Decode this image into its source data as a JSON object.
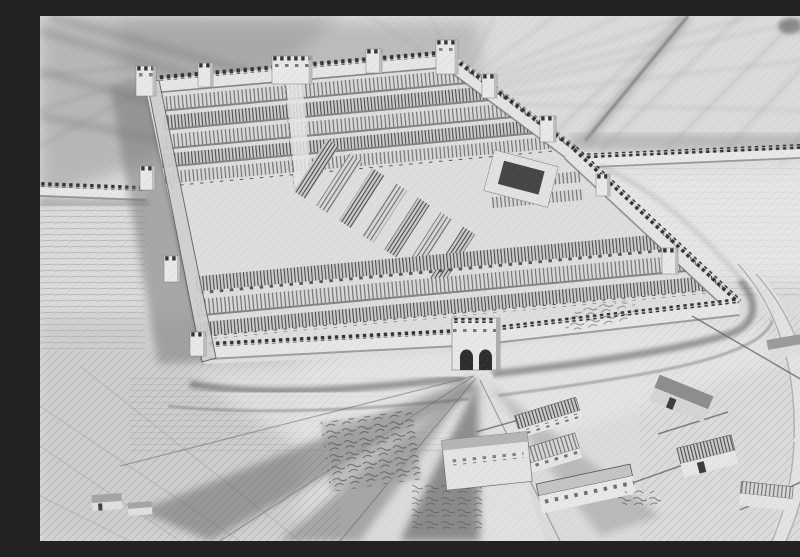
{
  "meta": {
    "title": "Bird's-eye reconstruction drawing of a Roman fort",
    "medium": "black-and-white engraving / pencil drawing, aerial perspective",
    "alt": "Aerial-perspective monochrome drawing of a walled Roman fort: crenellated curtain walls with corner and interval towers, a twin-arched south gatehouse, dense parallel rows of long barracks blocks inside, long walls running off to the left and right edges, a double ditch around the ramparts, dark roads radiating from the gate, sketched hatched farmland all around, and a small civilian settlement of pitched-roof houses in the foreground."
  },
  "palette": {
    "paper": "#e3e3e3",
    "highlight": "#f4f4f4",
    "field_mid": "#9a9a9a",
    "shade": "#6e6e6e",
    "ink_dark": "#1e1e1e",
    "wall_face": "#f0f0f0",
    "roof_light": "#e0e0e0",
    "roof_dark": "#d0d0d0"
  },
  "scene": {
    "fort": {
      "plan": "playing-card trapezoid seen in perspective",
      "walls": "crenellated stone rampart",
      "towers_count": 13,
      "south_gate": "double-arched gatehouse",
      "north_gate": "wide gate tower",
      "interior": "parallel rows of striped-roof barracks; angled central range with dark-roofed headquarters block",
      "ditch": "double ditch curving round the south and east sides"
    },
    "curtain_walls": {
      "left": "crenellated wall running to the west edge of the picture",
      "right": "crenellated wall running to the east edge of the picture"
    },
    "settlement": {
      "buildings_count": 10,
      "description": "vicus of small pitched-roof buildings, fences and lanes outside the south gate"
    },
    "roads": [
      "pale road leading south from the main gate",
      "dark shadowed tracks fanning to the south-west",
      "curved road sweeping round the south-east corner"
    ],
    "fields": "light sketchy hatched farmland with darker smudged sky-like shading in the upper corners"
  }
}
